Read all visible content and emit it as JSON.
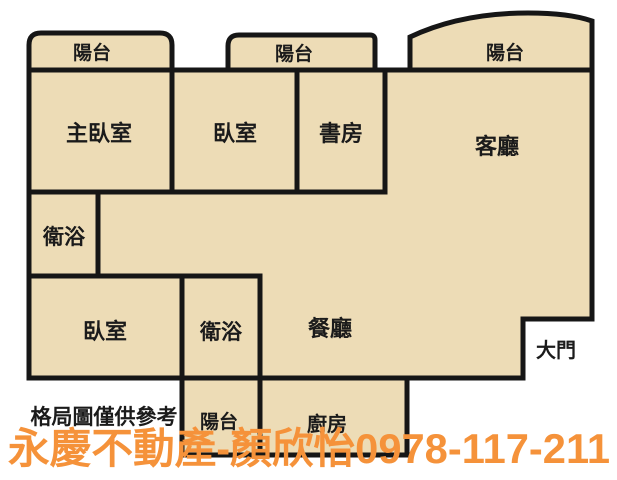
{
  "plan": {
    "colors": {
      "background": "#FFFFFF",
      "room_fill": "#EDDCB6",
      "wall": "#161616",
      "label": "#1B1B1B",
      "watermark_orange": "#F5923A"
    },
    "rooms": {
      "balcony_top_left": "陽台",
      "balcony_top_middle": "陽台",
      "balcony_top_right": "陽台",
      "master_bedroom": "主臥室",
      "bedroom_2": "臥室",
      "study": "書房",
      "living_room": "客廳",
      "bathroom_upper": "衛浴",
      "bedroom_3": "臥室",
      "bathroom_lower": "衛浴",
      "dining_room": "餐廳",
      "balcony_bottom": "陽台",
      "kitchen": "廚房"
    },
    "annotations": {
      "main_door": "大門",
      "disclaimer": "格局圖僅供參考",
      "watermark": "永慶不動產-顏欣怡0978-117-211"
    }
  }
}
